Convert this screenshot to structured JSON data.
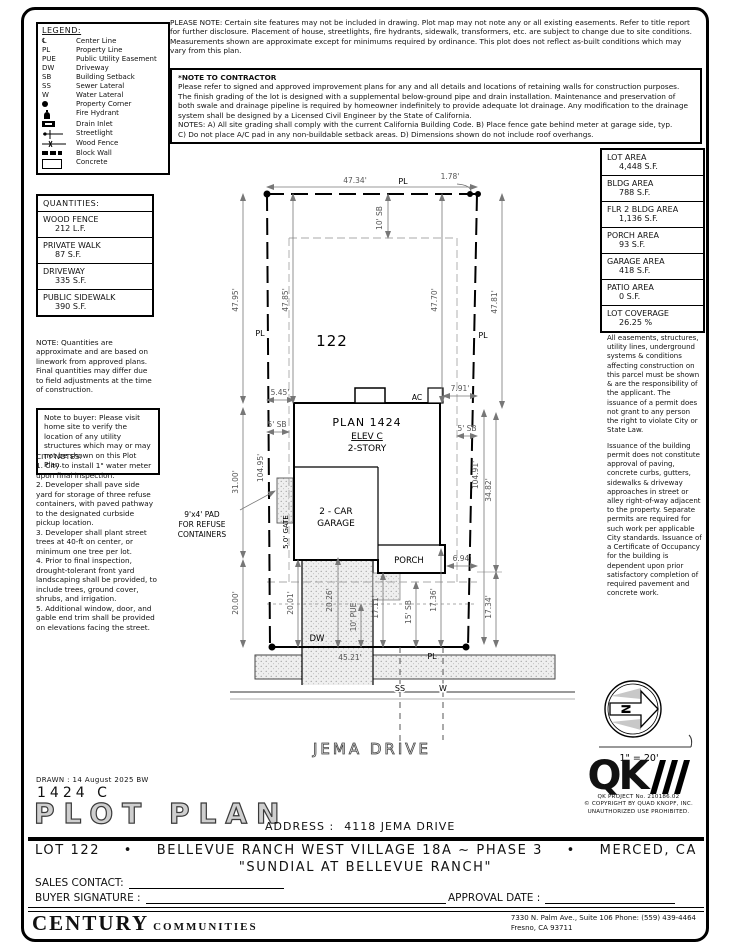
{
  "legend": {
    "title": "LEGEND:",
    "items": [
      {
        "sym": "℄",
        "label": "Center Line"
      },
      {
        "sym": "PL",
        "label": "Property Line"
      },
      {
        "sym": "PUE",
        "label": "Public Utility Easement"
      },
      {
        "sym": "DW",
        "label": "Driveway"
      },
      {
        "sym": "SB",
        "label": "Building Setback"
      },
      {
        "sym": "SS",
        "label": "Sewer Lateral"
      },
      {
        "sym": "W",
        "label": "Water Lateral"
      },
      {
        "icon": "property-corner-dot",
        "label": "Property Corner"
      },
      {
        "icon": "fire-hydrant",
        "label": "Fire Hydrant"
      },
      {
        "icon": "drain-inlet",
        "label": "Drain Inlet"
      },
      {
        "icon": "streetlight",
        "label": "Streetlight"
      },
      {
        "icon": "wood-fence",
        "label": "Wood Fence"
      },
      {
        "icon": "block-wall",
        "label": "Block Wall"
      },
      {
        "icon": "concrete",
        "label": "Concrete"
      }
    ]
  },
  "top_notes": {
    "please_note": "PLEASE NOTE:  Certain site features may not be included in drawing. Plot map may not note any or all existing easements. Refer to title report for further disclosure. Placement of house, streetlights, fire hydrants, sidewalk, transformers, etc. are subject to change due to site conditions. Measurements shown are approximate except for minimums required by ordinance. This plot does not reflect as-built conditions which may vary from this plan.",
    "contractor_title": "*NOTE TO CONTRACTOR",
    "contractor_body": "Please refer to signed and approved improvement plans for any and all details and locations of retaining walls for construction purposes. The finish grading of the lot is designed with a supplemental below-ground pipe and drain installation. Maintenance and preservation of both swale and drainage pipeline is required by homeowner indefinitely to provide adequate lot drainage. Any modification to the drainage system shall be designed by a Licensed Civil Engineer by the State of California.\nNOTES:  A) All site grading shall comply with the current California Building Code.  B) Place fence gate behind meter at garage side, typ.\nC) Do not place A/C pad in any non-buildable setback areas.  D) Dimensions shown do not include roof overhangs."
  },
  "quantities": {
    "title": "QUANTITIES:",
    "rows": [
      {
        "label": "WOOD FENCE",
        "value": "212 L.F."
      },
      {
        "label": "PRIVATE WALK",
        "value": "87 S.F."
      },
      {
        "label": "DRIVEWAY",
        "value": "335 S.F."
      },
      {
        "label": "PUBLIC SIDEWALK",
        "value": "390 S.F."
      }
    ],
    "note": "NOTE: Quantities are approximate and are based on linework from approved plans.  Final quantities may differ due to field adjustments at the time of construction.",
    "buyer_note": "Note to buyer: Please visit home site to verify the location of any utility structures which may or may not be shown on this Plot Plan."
  },
  "city_notes": "CITY NOTES:\n1. City to install 1\" water meter upon final inspection.\n2. Developer shall pave side yard for storage of three refuse containers, with paved pathway to the designated curbside pickup location.\n3. Developer shall plant street trees at 40-ft on center, or minimum one tree per lot.\n4. Prior to final inspection, drought-tolerant front yard landscaping shall be provided, to include trees, ground cover, shrubs, and irrigation.\n5. Additional window, door, and gable end trim shall be provided on elevations facing the street.",
  "areas": {
    "rows": [
      {
        "label": "LOT AREA",
        "value": "4,448 S.F."
      },
      {
        "label": "BLDG AREA",
        "value": "788 S.F."
      },
      {
        "label": "FLR 2 BLDG AREA",
        "value": "1,136 S.F."
      },
      {
        "label": "PORCH AREA",
        "value": "93 S.F."
      },
      {
        "label": "GARAGE AREA",
        "value": "418 S.F."
      },
      {
        "label": "PATIO AREA",
        "value": "0 S.F."
      },
      {
        "label": "LOT COVERAGE",
        "value": "26.25 %"
      }
    ]
  },
  "right_notes": {
    "p1": "All easements, structures, utility lines, underground systems & conditions affecting construction on this parcel must be shown & are the responsibility of the applicant. The issuance of a permit does not grant to any person the right to violate City or State Law.",
    "p2": "Issuance of the building permit does not constitute approval of paving, concrete curbs, gutters, sidewalks & driveway approaches in street or alley right-of-way adjacent to the property. Separate permits are required for such work per applicable City standards. Issuance of a Certificate of Occupancy for the building is dependent upon prior satisfactory completion of required pavement and concrete work."
  },
  "plot": {
    "lot_number": "122",
    "plan_name": "PLAN 1424",
    "plan_elev": "ELEV C",
    "plan_story": "2-STORY",
    "garage_line1": "2 - CAR",
    "garage_line2": "GARAGE",
    "porch_label": "PORCH",
    "ac_label": "AC",
    "dw_label": "DW",
    "ss_label": "SS",
    "w_label": "W",
    "pl_top": "PL",
    "pl_left": "PL",
    "pl_right": "PL",
    "pl_bottom": "PL",
    "gate_label": "5.0' GATE",
    "refuse_line1": "9'x4' PAD",
    "refuse_line2": "FOR REFUSE",
    "refuse_line3": "CONTAINERS",
    "street_name": "JEMA DRIVE",
    "north_label": "N",
    "scale_label": "1\" = 20'",
    "dims": {
      "top_width": "47.34'",
      "corner_offset": "1.78'",
      "rear_setback": "10' SB",
      "left_outer": "47.95'",
      "left_inner": "47.85'",
      "right_inner": "47.70'",
      "right_outer": "47.81'",
      "house_left_offset": "5.45'",
      "ac_offset": "7.91'",
      "side_setback_left": "5' SB",
      "side_setback_right": "5' SB",
      "left_mid": "31.00'",
      "lot_depth_left": "104.95'",
      "lot_depth_right": "104.91'",
      "right_mid": "34.82'",
      "porch_offset": "6.94'",
      "front_left_outer": "20.00'",
      "front_garage": "20.01'",
      "driveway_depth": "20.26'",
      "pue": "10' PUE",
      "front_porch": "17.11'",
      "front_setback": "15' SB",
      "front_house": "17.36'",
      "front_right": "17.34'",
      "front_width": "45.21'"
    }
  },
  "title_block": {
    "drawn": "DRAWN :  14 August 2025  BW",
    "plan_code": "1424  C",
    "title": "PLOT PLAN",
    "address_label": "ADDRESS :",
    "address_value": "4118 JEMA DRIVE"
  },
  "qk": {
    "logo": "QK",
    "project": "QK PROJECT No. 210186.02",
    "copyright1": "© COPYRIGHT BY QUAD KNOPF, INC.",
    "copyright2": "UNAUTHORIZED USE PROHIBITED."
  },
  "footer": {
    "lot": "LOT 122",
    "bullet": "•",
    "community": "BELLEVUE RANCH WEST VILLAGE 18A ~ PHASE 3",
    "city": "MERCED, CA",
    "subdivision": "\"SUNDIAL AT BELLEVUE RANCH\"",
    "sales_contact_label": "SALES CONTACT:",
    "buyer_signature_label": "BUYER SIGNATURE :",
    "approval_date_label": "APPROVAL DATE :",
    "company_name": "CENTURY",
    "company_name2": "COMMUNITIES",
    "address_line1": "7330 N. Palm Ave., Suite 106    Phone:  (559) 439-4464",
    "address_line2": "Fresno, CA  93711"
  }
}
